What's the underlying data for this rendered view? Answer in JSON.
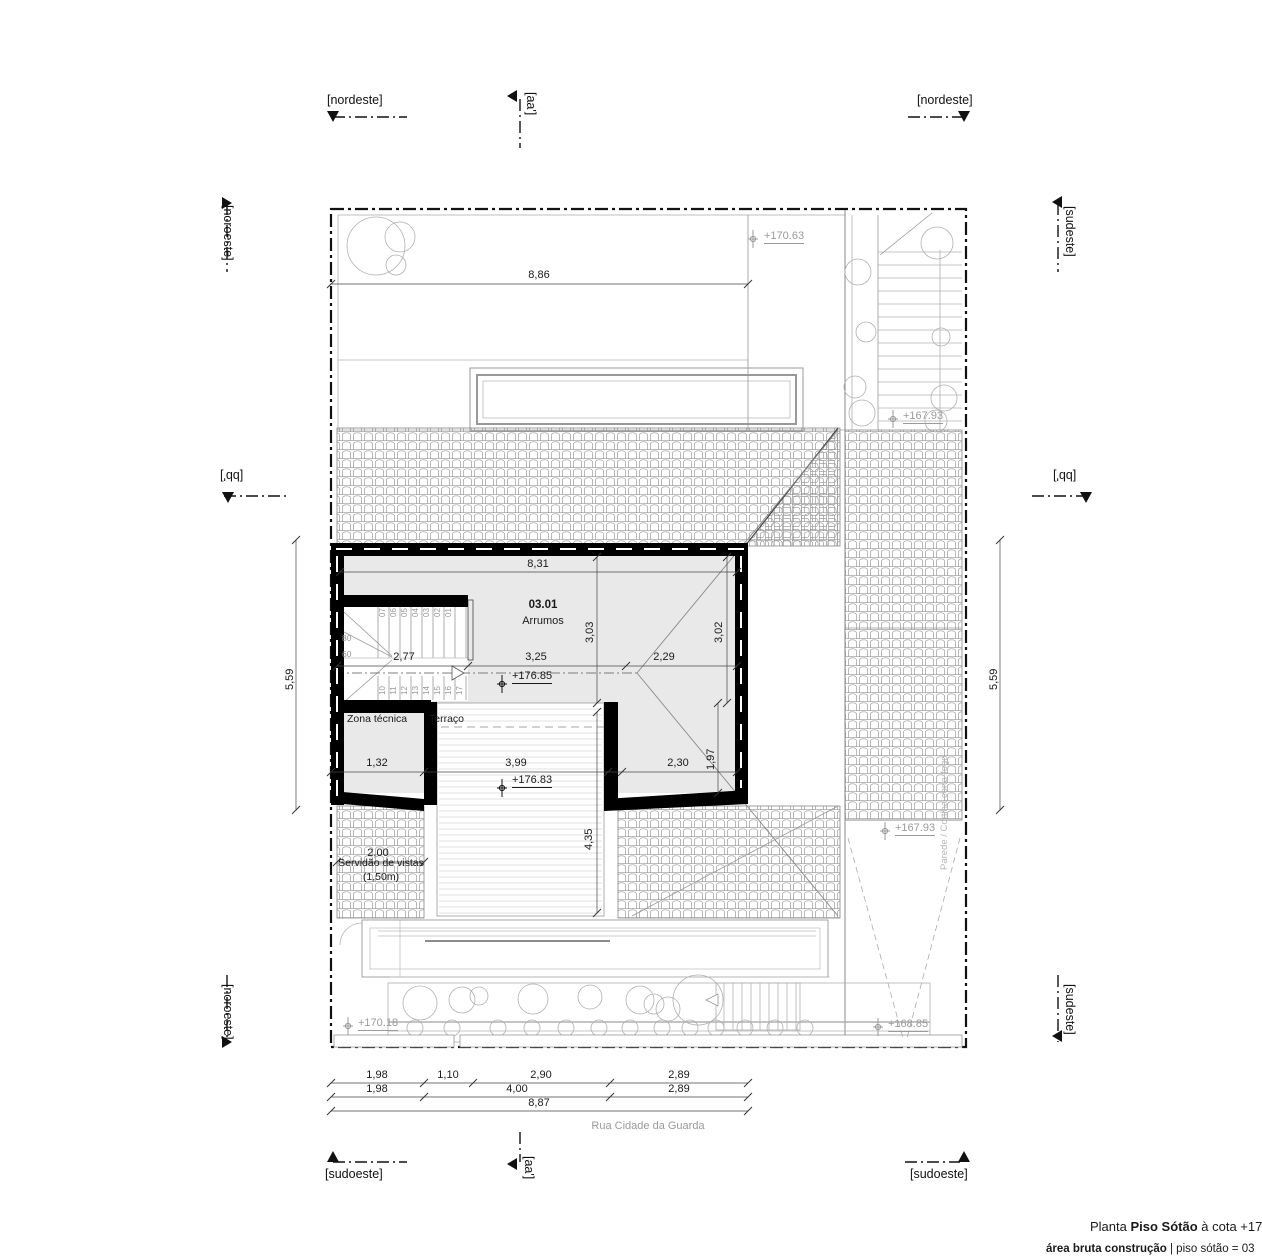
{
  "markers": {
    "top_left": "[nordeste]",
    "top_center": "[aa']",
    "top_right": "[nordeste]",
    "left_top": "[noroeste]",
    "left_mid": "[bb']",
    "left_bottom": "[noroeste]",
    "right_top": "[sudeste]",
    "right_mid": "[bb']",
    "right_bottom": "[sudeste]",
    "bottom_left": "[sudoeste]",
    "bottom_center": "[aa']",
    "bottom_right": "[sudoeste]"
  },
  "dims": {
    "site_width": "8,86",
    "site_height_left": "5,59",
    "site_height_right": "5,59",
    "room_width": "8,31",
    "room_depth_left": "3,03",
    "room_depth_right": "3,02",
    "stair_width": "2,77",
    "mid_center": "3,25",
    "mid_right": "2,29",
    "zona_width": "1,32",
    "terrace_width": "3,99",
    "lower_right": "2,30",
    "right_depth": "1,97",
    "terrace_depth": "4,35",
    "servidao_width": "2,00",
    "row1": [
      "1,98",
      "1,10",
      "2,90",
      "2,89"
    ],
    "row2": [
      "1,98",
      "4,00",
      "2,89"
    ],
    "total": "8,87"
  },
  "levels": {
    "garden_top": "+170.63",
    "stair_landing": "+167.93",
    "roof_right": "+167.93",
    "attic": "+176.85",
    "terrace": "+176.83",
    "street_left": "+170.18",
    "ramp": "+168.85"
  },
  "rooms": {
    "main_number": "03.01",
    "main_name": "Arrumos",
    "zona_tecnica": "Zona técnica",
    "terraco": "Terraço"
  },
  "labels": {
    "servidao_line1": "Servidão de vistas",
    "servidao_line2": "(1,50m)",
    "street": "Rua Cidade da Guarda",
    "firewall": "Parede / Cortina corta-fogo",
    "tread_17": "17"
  },
  "stairs": {
    "upper": [
      "07",
      "06",
      "05",
      "04",
      "03",
      "02",
      "01"
    ],
    "lower": [
      "10",
      "11",
      "12",
      "13",
      "14",
      "15",
      "16",
      "17"
    ],
    "width_labels": [
      "80",
      "60"
    ]
  },
  "title": {
    "prefix": "Planta ",
    "bold": "Piso Sótão",
    "suffix": " à cota +176.85",
    "line2_bold": "área bruta construção",
    "line2_rest": " | piso sótão = 03"
  }
}
